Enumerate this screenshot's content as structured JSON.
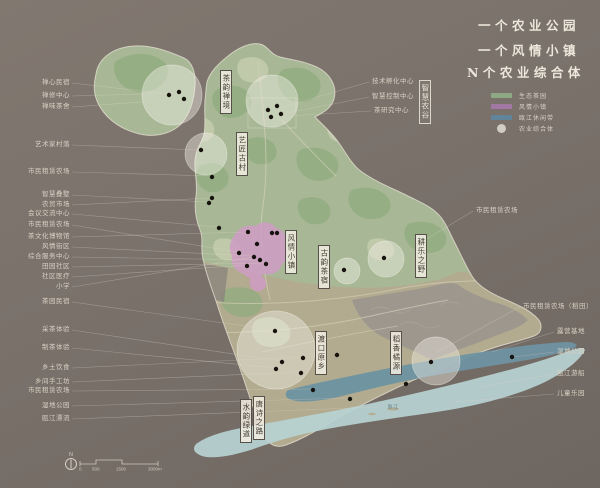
{
  "titles": [
    "一个农业公园",
    "一个风情小镇",
    "N个农业综合体"
  ],
  "legend": {
    "items": [
      {
        "label": "生态茶园",
        "swatch": "bar",
        "color": "#8fae85"
      },
      {
        "label": "风情小镇",
        "swatch": "bar",
        "color": "#a678ab"
      },
      {
        "label": "瓯江休闲带",
        "swatch": "bar",
        "color": "#5d87a0"
      },
      {
        "label": "农业综合体",
        "swatch": "circle",
        "color": "#e9e5d8"
      }
    ]
  },
  "callouts": {
    "left": [
      {
        "text": "禅心民宿",
        "y": 83,
        "tx": 168,
        "ty": 94
      },
      {
        "text": "禅修中心",
        "y": 96,
        "tx": 177,
        "ty": 93
      },
      {
        "text": "禅味茶舍",
        "y": 107,
        "tx": 183,
        "ty": 99
      },
      {
        "text": "艺术家村落",
        "y": 145,
        "tx": 199,
        "ty": 150
      },
      {
        "text": "市民租赁农场",
        "y": 172,
        "tx": 210,
        "ty": 176
      },
      {
        "text": "智慧叠墅",
        "y": 195,
        "tx": 208,
        "ty": 202
      },
      {
        "text": "农贸市场",
        "y": 205,
        "tx": 211,
        "ty": 198
      },
      {
        "text": "会议交流中心",
        "y": 214,
        "tx": 218,
        "ty": 227
      },
      {
        "text": "市民租赁农场",
        "y": 225,
        "tx": 238,
        "ty": 252
      },
      {
        "text": "茶文化博物馆",
        "y": 237,
        "tx": 246,
        "ty": 232
      },
      {
        "text": "风情街区",
        "y": 247,
        "tx": 253,
        "ty": 256
      },
      {
        "text": "综合服务中心",
        "y": 257,
        "tx": 259,
        "ty": 260
      },
      {
        "text": "田园社区",
        "y": 267,
        "tx": 265,
        "ty": 263
      },
      {
        "text": "社区医疗",
        "y": 277,
        "tx": 247,
        "ty": 265
      },
      {
        "text": "小学",
        "y": 287,
        "tx": 254,
        "ty": 257
      },
      {
        "text": "茶园民宿",
        "y": 302,
        "tx": 274,
        "ty": 330
      },
      {
        "text": "采茶体验",
        "y": 330,
        "tx": 281,
        "ty": 361
      },
      {
        "text": "制茶体验",
        "y": 348,
        "tx": 276,
        "ty": 368
      },
      {
        "text": "乡土饮食",
        "y": 368,
        "tx": 302,
        "ty": 357
      },
      {
        "text": "乡间手工坊",
        "y": 382,
        "tx": 300,
        "ty": 372
      },
      {
        "text": "市民租赁农场",
        "y": 391,
        "tx": 312,
        "ty": 389
      },
      {
        "text": "湿地公园",
        "y": 406,
        "tx": 349,
        "ty": 398
      },
      {
        "text": "瓯江漂流",
        "y": 419,
        "tx": 378,
        "ty": 407
      }
    ],
    "right": [
      {
        "text": "技术孵化中心",
        "x": 372,
        "y": 82,
        "tx": 283,
        "ty": 107
      },
      {
        "text": "智慧控制中心",
        "x": 372,
        "y": 97,
        "tx": 282,
        "ty": 114
      },
      {
        "text": "茶研究中心",
        "x": 374,
        "y": 111,
        "tx": 273,
        "ty": 117
      },
      {
        "text": "市民租赁农场",
        "x": 476,
        "y": 211,
        "tx": 420,
        "ty": 243
      },
      {
        "text": "市民租赁农场（稻田）",
        "x": 523,
        "y": 307,
        "tx": 437,
        "ty": 352
      },
      {
        "text": "露营基地",
        "x": 557,
        "y": 332,
        "tx": 492,
        "ty": 352
      },
      {
        "text": "湿地公园",
        "x": 557,
        "y": 352,
        "tx": 513,
        "ty": 357
      },
      {
        "text": "瓯江游船",
        "x": 557,
        "y": 374,
        "tx": 480,
        "ty": 387
      },
      {
        "text": "儿童乐园",
        "x": 557,
        "y": 394,
        "tx": 452,
        "ty": 402
      }
    ]
  },
  "map_labels": [
    {
      "text": "茶韵禅境",
      "x": 220,
      "y": 70,
      "theme": "light"
    },
    {
      "text": "艺匠古村",
      "x": 236,
      "y": 132,
      "theme": "light"
    },
    {
      "text": "风情小镇",
      "x": 285,
      "y": 230,
      "theme": "light"
    },
    {
      "text": "古韵茶宿",
      "x": 318,
      "y": 245,
      "theme": "light"
    },
    {
      "text": "耕乐之野",
      "x": 415,
      "y": 234,
      "theme": "light"
    },
    {
      "text": "渡口原乡",
      "x": 315,
      "y": 331,
      "theme": "light"
    },
    {
      "text": "稻香橘源",
      "x": 390,
      "y": 331,
      "theme": "light"
    },
    {
      "text": "唐诗之路",
      "x": 253,
      "y": 396,
      "theme": "light"
    },
    {
      "text": "水韵绿道",
      "x": 240,
      "y": 399,
      "theme": "light"
    },
    {
      "text": "智慧农谷",
      "x": 419,
      "y": 80,
      "theme": "dark"
    }
  ],
  "pois": [
    [
      169,
      95
    ],
    [
      179,
      92
    ],
    [
      184,
      99
    ],
    [
      268,
      110
    ],
    [
      277,
      106
    ],
    [
      281,
      114
    ],
    [
      271,
      117
    ],
    [
      201,
      150
    ],
    [
      212,
      177
    ],
    [
      212,
      198
    ],
    [
      209,
      203
    ],
    [
      219,
      228
    ],
    [
      248,
      232
    ],
    [
      272,
      233
    ],
    [
      277,
      233
    ],
    [
      257,
      244
    ],
    [
      239,
      253
    ],
    [
      254,
      257
    ],
    [
      260,
      260
    ],
    [
      266,
      264
    ],
    [
      247,
      266
    ],
    [
      344,
      270
    ],
    [
      384,
      258
    ],
    [
      275,
      331
    ],
    [
      282,
      362
    ],
    [
      276,
      369
    ],
    [
      303,
      358
    ],
    [
      301,
      373
    ],
    [
      313,
      390
    ],
    [
      337,
      355
    ],
    [
      350,
      399
    ],
    [
      406,
      384
    ],
    [
      431,
      362
    ],
    [
      512,
      357
    ]
  ],
  "complex_circles": [
    [
      172,
      95,
      30
    ],
    [
      272,
      101,
      26
    ],
    [
      206,
      154,
      21
    ],
    [
      347,
      271,
      13
    ],
    [
      386,
      259,
      18
    ],
    [
      276,
      350,
      39
    ],
    [
      436,
      361,
      24
    ]
  ],
  "river_label": "瓯江",
  "scalebar": {
    "north": "N",
    "labels": [
      "0",
      "500",
      "1500",
      "3000m"
    ]
  },
  "colors": {
    "land": "#a8b896",
    "land_dark": "#8fab7e",
    "land_light": "#c6cdb0",
    "south_band": "#b2aa8e",
    "mountain": "#9d968e",
    "town_purple": "#cf9cc5",
    "river": "#6e92a2",
    "belt": "#b7d2d3",
    "outline": "#e7e2d4"
  }
}
